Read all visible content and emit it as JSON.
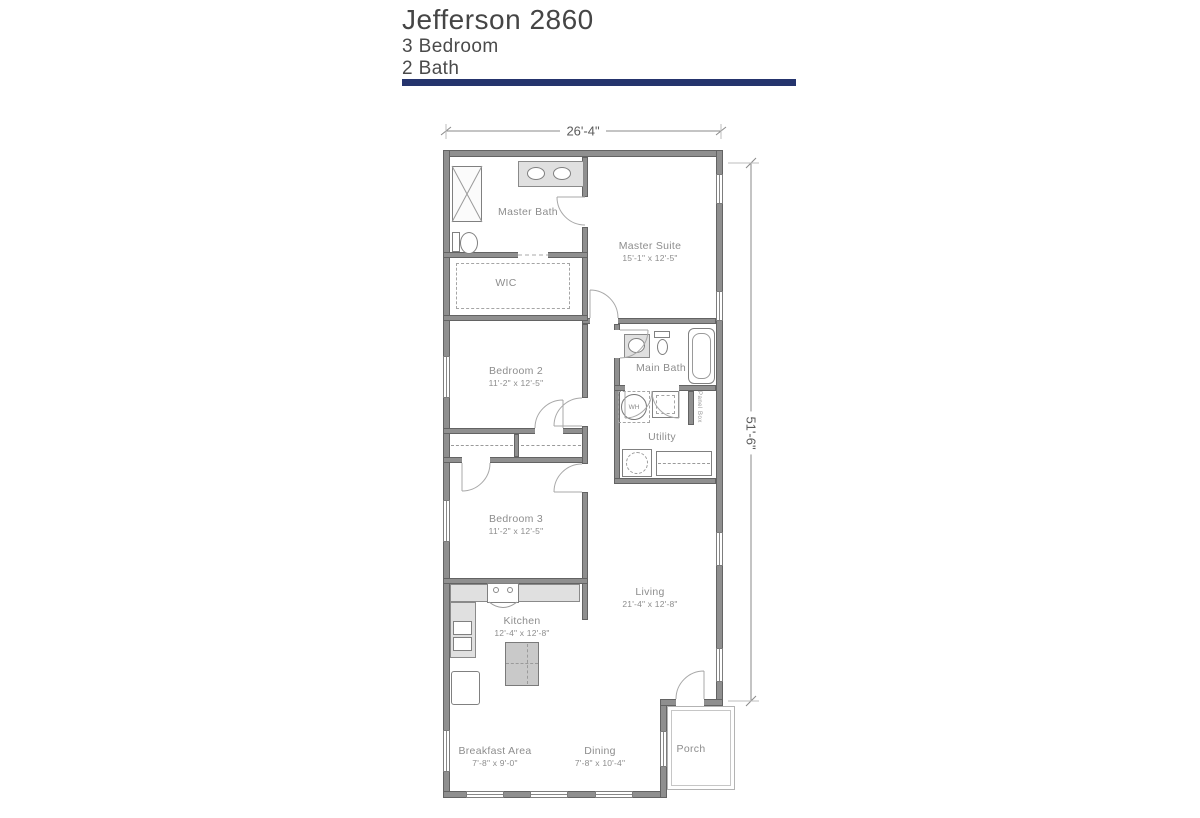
{
  "header": {
    "title": "Jefferson 2860",
    "bedrooms": "3 Bedroom",
    "baths": "2 Bath"
  },
  "dimensions": {
    "width": "26'-4\"",
    "depth": "51'-6\""
  },
  "rooms": {
    "master_bath": {
      "name": "Master Bath",
      "dims": ""
    },
    "master_suite": {
      "name": "Master Suite",
      "dims": "15'-1\" x 12'-5\""
    },
    "wic": {
      "name": "WIC",
      "dims": ""
    },
    "bedroom2": {
      "name": "Bedroom 2",
      "dims": "11'-2\" x 12'-5\""
    },
    "main_bath": {
      "name": "Main Bath",
      "dims": ""
    },
    "utility": {
      "name": "Utility",
      "dims": ""
    },
    "bedroom3": {
      "name": "Bedroom 3",
      "dims": "11'-2\" x 12'-5\""
    },
    "kitchen": {
      "name": "Kitchen",
      "dims": "12'-4\" x 12'-8\""
    },
    "living": {
      "name": "Living",
      "dims": "21'-4\" x 12'-8\""
    },
    "breakfast": {
      "name": "Breakfast Area",
      "dims": "7'-8\" x 9'-0\""
    },
    "dining": {
      "name": "Dining",
      "dims": "7'-8\" x 10'-4\""
    },
    "porch": {
      "name": "Porch",
      "dims": ""
    }
  },
  "fixtures": {
    "water_heater": "WH",
    "panel_box": "Panel Box"
  },
  "colors": {
    "accent_bar": "#25346d",
    "wall": "#8f8f8f",
    "label_text": "#8d8d8d"
  }
}
